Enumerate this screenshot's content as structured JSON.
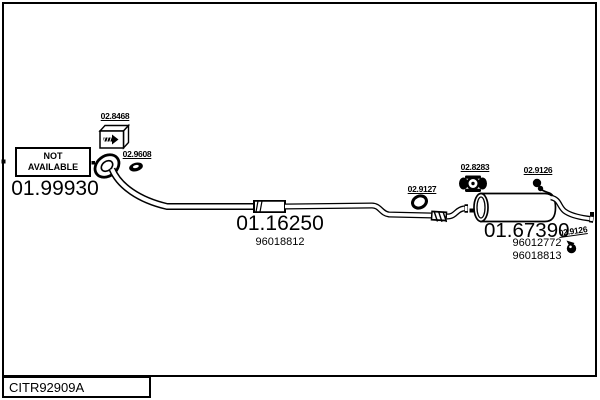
{
  "frame": {
    "code": "CITR92909A"
  },
  "not_available": {
    "line1": "NOT",
    "line2": "AVAILABLE"
  },
  "parts": {
    "front_pipe": {
      "ref": "01.99930"
    },
    "fitting_kit": {
      "ref": "02.8468"
    },
    "gasket": {
      "ref": "02.9608"
    },
    "centre_pipe": {
      "ref": "01.16250",
      "oem": "96018812"
    },
    "mounting_ring": {
      "ref": "02.9127"
    },
    "clamp": {
      "ref": "02.8283"
    },
    "hanger_top": {
      "ref": "02.9126"
    },
    "rear_silencer": {
      "ref": "01.67390",
      "oem_1": "96012772",
      "oem_2": "96018813"
    },
    "hanger_rear": {
      "ref": "02.9126"
    }
  },
  "colors": {
    "ink": "#000000",
    "background": "#ffffff"
  }
}
